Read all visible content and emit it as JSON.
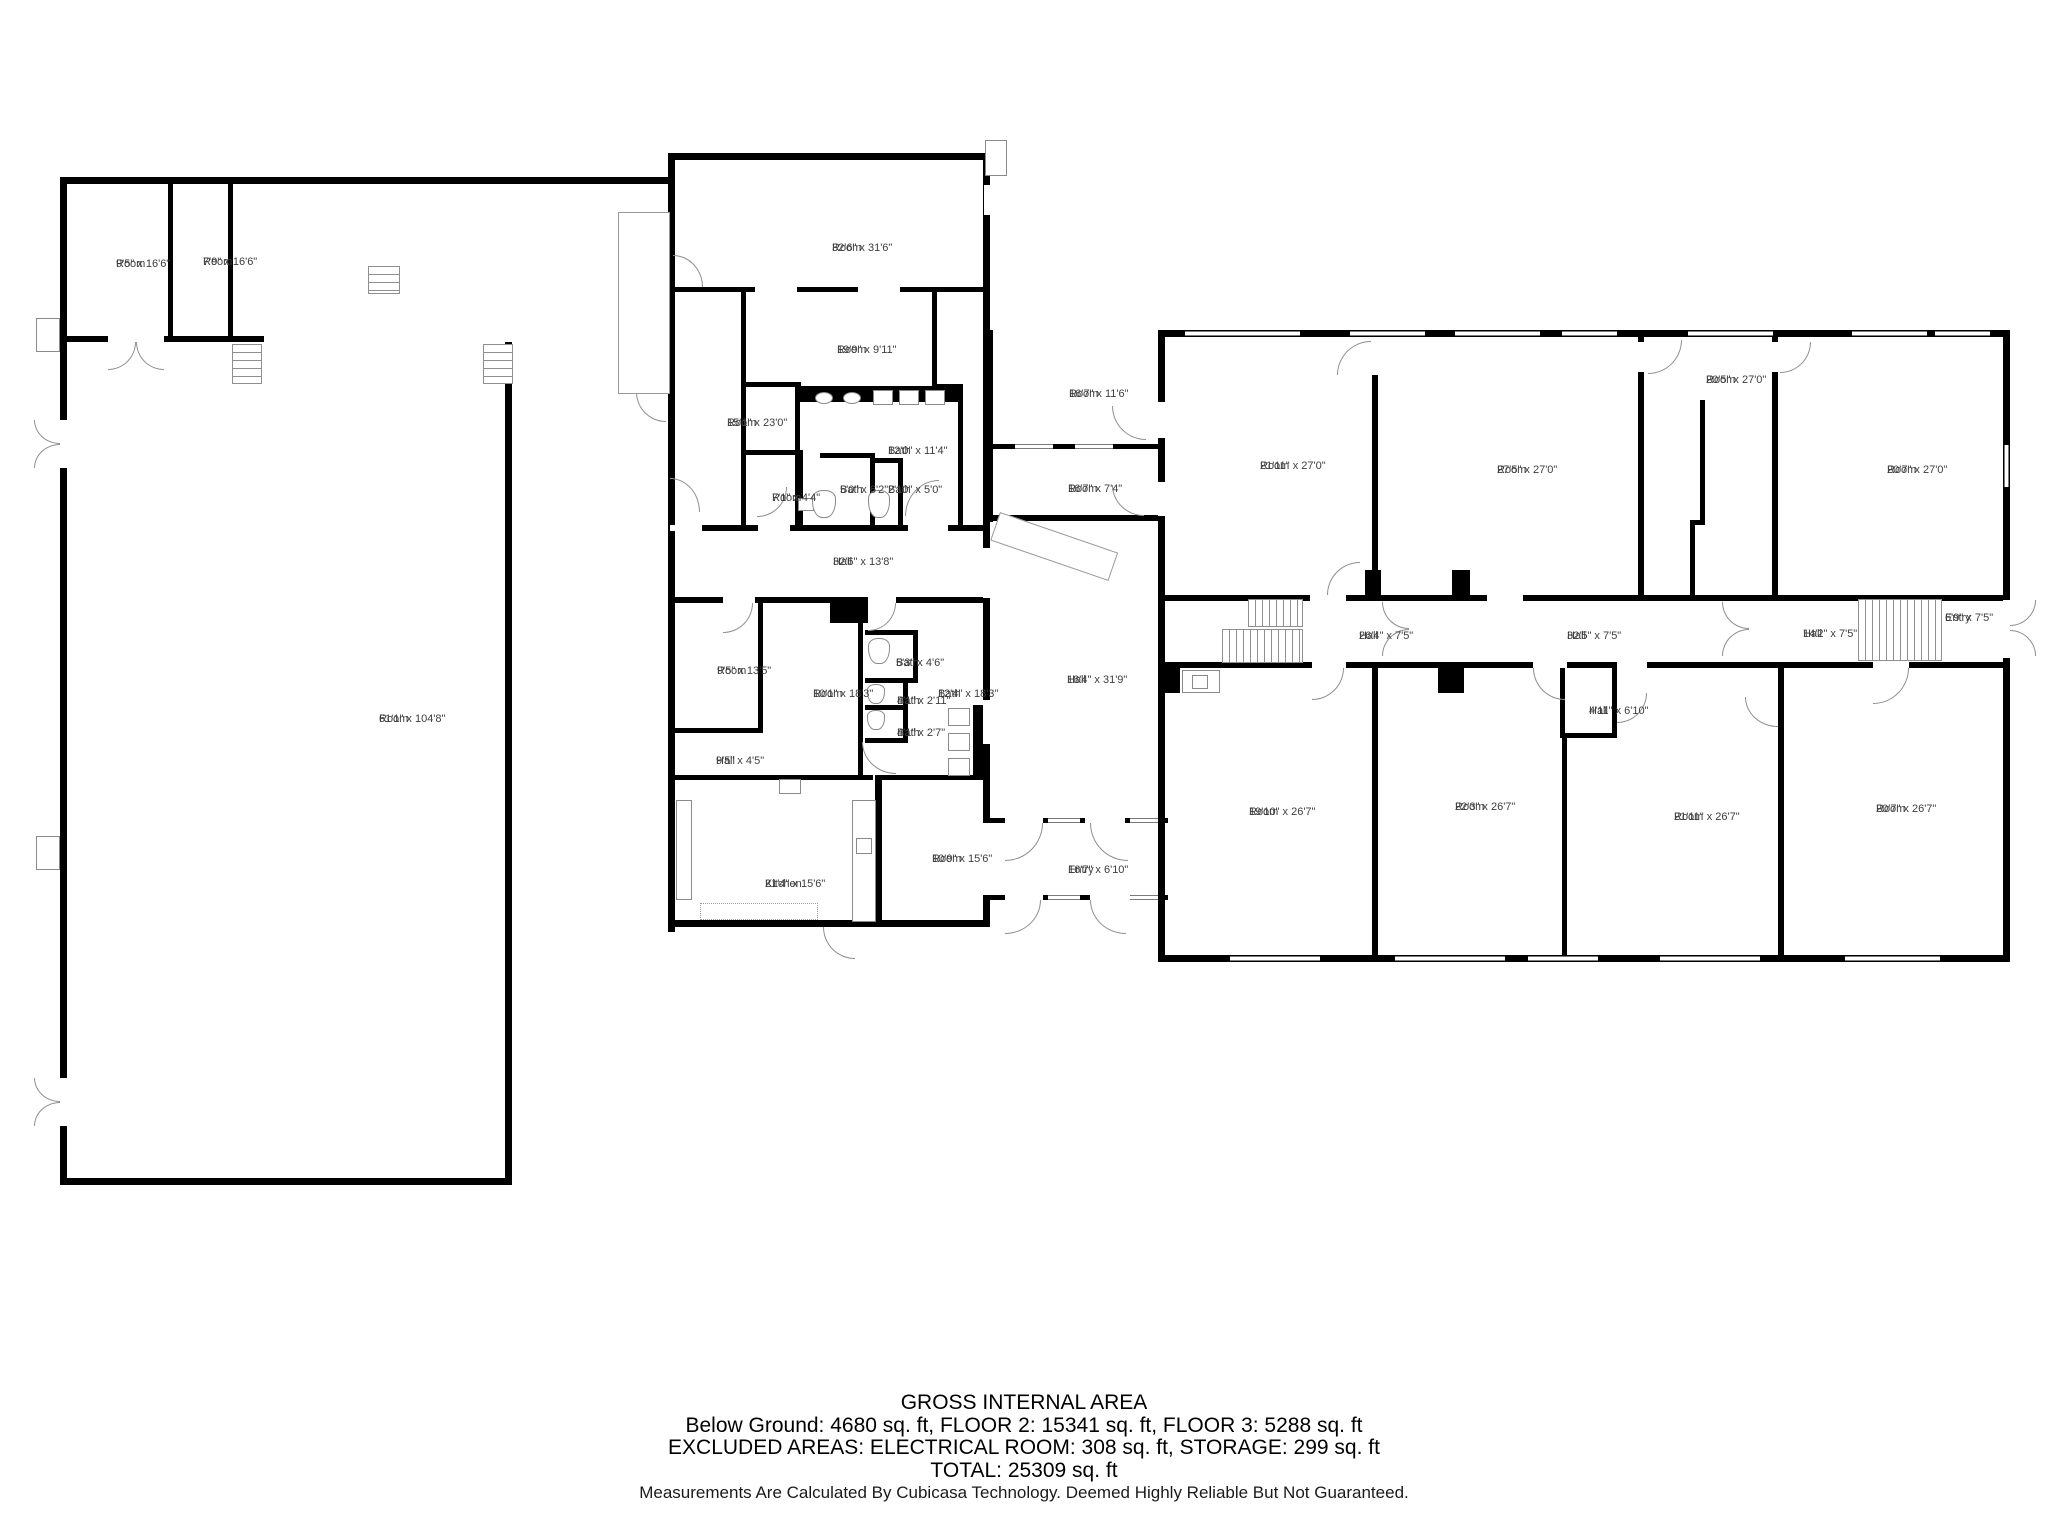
{
  "plan": {
    "rooms": [
      {
        "label": "Room",
        "dims": "9'5\" x 16'6\"",
        "x": 116,
        "y": 258
      },
      {
        "label": "Room",
        "dims": "7'9\" x 16'6\"",
        "x": 203,
        "y": 256
      },
      {
        "label": "Room",
        "dims": "61'1\" x 104'8\"",
        "x": 379,
        "y": 713
      },
      {
        "label": "Room",
        "dims": "32'6\" x 31'6\"",
        "x": 832,
        "y": 242
      },
      {
        "label": "Room",
        "dims": "19'9\" x 9'11\"",
        "x": 837,
        "y": 344
      },
      {
        "label": "Room",
        "dims": "15'1\" x 23'0\"",
        "x": 727,
        "y": 417
      },
      {
        "label": "Bath",
        "dims": "12'0\" x 11'4\"",
        "x": 888,
        "y": 445
      },
      {
        "label": "Room",
        "dims": "7'1\" x 4'4\"",
        "x": 772,
        "y": 492
      },
      {
        "label": "Bath",
        "dims": "5'0\" x 6'2\"",
        "x": 840,
        "y": 484
      },
      {
        "label": "Bath",
        "dims": "2'10\" x 5'0\"",
        "x": 888,
        "y": 484
      },
      {
        "label": "Hall",
        "dims": "32'6\" x 13'8\"",
        "x": 833,
        "y": 556
      },
      {
        "label": "Room",
        "dims": "16'7\" x 11'6\"",
        "x": 1069,
        "y": 388
      },
      {
        "label": "Room",
        "dims": "16'7\" x 7'4\"",
        "x": 1068,
        "y": 483
      },
      {
        "label": "Hall",
        "dims": "18'4\" x 31'9\"",
        "x": 1067,
        "y": 674
      },
      {
        "label": "Room",
        "dims": "9'5\" x 13'5\"",
        "x": 717,
        "y": 665
      },
      {
        "label": "Room",
        "dims": "10'1\" x 18'3\"",
        "x": 813,
        "y": 688
      },
      {
        "label": "Bath",
        "dims": "5'3\" x 4'6\"",
        "x": 896,
        "y": 657
      },
      {
        "label": "Bath",
        "dims": "4'1\" x 2'11\"",
        "x": 897,
        "y": 695
      },
      {
        "label": "Bath",
        "dims": "4'1\" x 2'7\"",
        "x": 897,
        "y": 727
      },
      {
        "label": "Bath",
        "dims": "12'4\" x 18'3\"",
        "x": 938,
        "y": 688
      },
      {
        "label": "Hall",
        "dims": "9'5\" x 4'5\"",
        "x": 716,
        "y": 755
      },
      {
        "label": "Kitchen",
        "dims": "21'4\" x 15'6\"",
        "x": 765,
        "y": 878
      },
      {
        "label": "Room",
        "dims": "10'9\" x 15'6\"",
        "x": 932,
        "y": 853
      },
      {
        "label": "Entry",
        "dims": "16'7\" x 6'10\"",
        "x": 1068,
        "y": 864
      },
      {
        "label": "Room",
        "dims": "21'11\" x 27'0\"",
        "x": 1260,
        "y": 460
      },
      {
        "label": "Room",
        "dims": "27'5\" x 27'0\"",
        "x": 1497,
        "y": 464
      },
      {
        "label": "Room",
        "dims": "20'5\" x 27'0\"",
        "x": 1706,
        "y": 374
      },
      {
        "label": "Room",
        "dims": "20'7\" x 27'0\"",
        "x": 1887,
        "y": 464
      },
      {
        "label": "Hall",
        "dims": "26'4\" x 7'5\"",
        "x": 1359,
        "y": 630
      },
      {
        "label": "Hall",
        "dims": "32'5\" x 7'5\"",
        "x": 1567,
        "y": 630
      },
      {
        "label": "Hall",
        "dims": "14'2\" x 7'5\"",
        "x": 1803,
        "y": 628
      },
      {
        "label": "Entry",
        "dims": "6'9\" x 7'5\"",
        "x": 1945,
        "y": 612
      },
      {
        "label": "Room",
        "dims": "19'10\" x 26'7\"",
        "x": 1249,
        "y": 806
      },
      {
        "label": "Room",
        "dims": "22'3\" x 26'7\"",
        "x": 1455,
        "y": 801
      },
      {
        "label": "Room",
        "dims": "21'11\" x 26'7\"",
        "x": 1674,
        "y": 811
      },
      {
        "label": "Room",
        "dims": "20'7\" x 26'7\"",
        "x": 1876,
        "y": 803
      },
      {
        "label": "Hall",
        "dims": "4'11\" x 6'10\"",
        "x": 1589,
        "y": 705
      }
    ]
  },
  "footer": {
    "title": "GROSS INTERNAL AREA",
    "areas_line": "Below Ground: 4680 sq. ft, FLOOR 2: 15341 sq. ft, FLOOR 3: 5288 sq. ft",
    "excluded_line": "EXCLUDED AREAS: ELECTRICAL ROOM: 308 sq. ft, STORAGE: 299 sq. ft",
    "total_line": "TOTAL: 25309 sq. ft",
    "disclaimer": "Measurements Are Calculated By Cubicasa Technology. Deemed Highly Reliable But Not Guaranteed."
  }
}
